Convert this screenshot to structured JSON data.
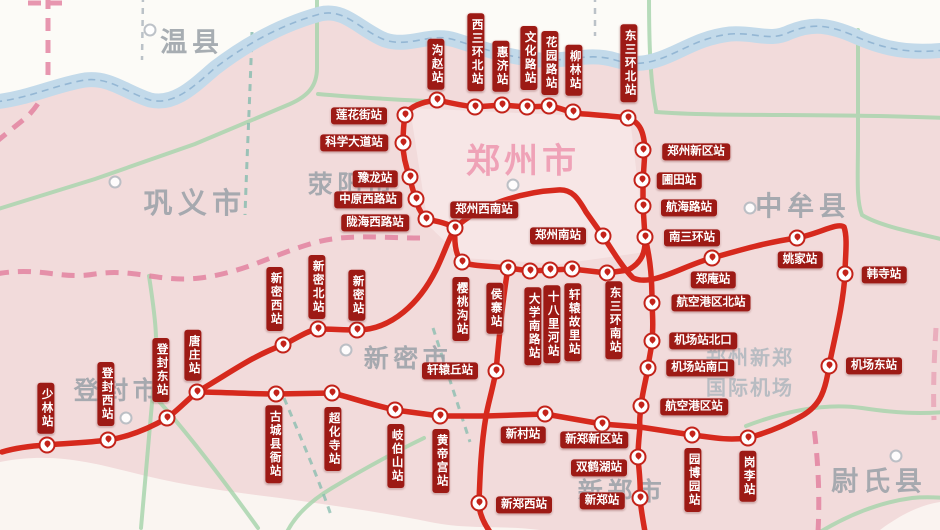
{
  "map": {
    "colors": {
      "background": "#f2dbdb",
      "line_red": "#d6291d",
      "label_bg": "#9d1a15",
      "label_text": "#ffffff",
      "river_blue": "#c3daea",
      "road_green": "#a5d4ab",
      "boundary_pink": "#e27d9d",
      "region_text": "#9ba2a9",
      "city_accent_pink": "#ef9fb5"
    },
    "regions": [
      {
        "name": "温县",
        "x": 192,
        "y": 40,
        "size": 27,
        "accent": false
      },
      {
        "name": "巩义市",
        "x": 195,
        "y": 201,
        "size": 29,
        "accent": false
      },
      {
        "name": "荥阳市",
        "x": 352,
        "y": 183,
        "size": 25,
        "accent": false
      },
      {
        "name": "郑州市",
        "x": 523,
        "y": 158,
        "size": 34,
        "accent": true
      },
      {
        "name": "中牟县",
        "x": 803,
        "y": 204,
        "size": 27,
        "accent": false
      },
      {
        "name": "新密市",
        "x": 408,
        "y": 357,
        "size": 25,
        "accent": false
      },
      {
        "name": "登封市",
        "x": 118,
        "y": 389,
        "size": 25,
        "accent": false
      },
      {
        "name": "新郑市",
        "x": 622,
        "y": 490,
        "size": 25,
        "accent": false
      },
      {
        "name": "尉氏县",
        "x": 879,
        "y": 479,
        "size": 27,
        "accent": false
      }
    ],
    "airport": {
      "line1": "郑州新郑",
      "line2": "国际机场",
      "x": 750,
      "y1": 356,
      "y2": 386
    },
    "city_markers": [
      [
        150,
        30
      ],
      [
        115,
        182
      ],
      [
        513,
        185
      ],
      [
        750,
        208
      ],
      [
        346,
        350
      ],
      [
        126,
        418
      ],
      [
        896,
        456
      ]
    ],
    "stations": [
      {
        "name": "沟赵站",
        "dot": [
          437,
          100
        ],
        "label": [
          436,
          64
        ],
        "dir": "v"
      },
      {
        "name": "西三环北站",
        "dot": [
          475,
          107
        ],
        "label": [
          476,
          52
        ],
        "dir": "v"
      },
      {
        "name": "惠济站",
        "dot": [
          502,
          105
        ],
        "label": [
          501,
          66
        ],
        "dir": "v"
      },
      {
        "name": "文化路站",
        "dot": [
          527,
          107
        ],
        "label": [
          529,
          58
        ],
        "dir": "v"
      },
      {
        "name": "花园路站",
        "dot": [
          549,
          106
        ],
        "label": [
          550,
          63
        ],
        "dir": "v"
      },
      {
        "name": "柳林站",
        "dot": [
          573,
          112
        ],
        "label": [
          574,
          70
        ],
        "dir": "v"
      },
      {
        "name": "东三环北站",
        "dot": [
          628,
          118
        ],
        "label": [
          629,
          63
        ],
        "dir": "v"
      },
      {
        "name": "郑州新区站",
        "dot": [
          643,
          150
        ],
        "label": [
          696,
          152
        ],
        "dir": "h"
      },
      {
        "name": "圃田站",
        "dot": [
          642,
          180
        ],
        "label": [
          679,
          181
        ],
        "dir": "h"
      },
      {
        "name": "航海路站",
        "dot": [
          643,
          206
        ],
        "label": [
          689,
          208
        ],
        "dir": "h"
      },
      {
        "name": "南三环站",
        "dot": [
          645,
          237
        ],
        "label": [
          692,
          238
        ],
        "dir": "h"
      },
      {
        "name": "郑庵站",
        "dot": [
          712,
          258
        ],
        "label": [
          713,
          280
        ],
        "dir": "h"
      },
      {
        "name": "姚家站",
        "dot": [
          797,
          238
        ],
        "label": [
          800,
          260
        ],
        "dir": "h"
      },
      {
        "name": "韩寺站",
        "dot": [
          845,
          274
        ],
        "label": [
          884,
          275
        ],
        "dir": "h"
      },
      {
        "name": "机场东站",
        "dot": [
          829,
          366
        ],
        "label": [
          874,
          366
        ],
        "dir": "h"
      },
      {
        "name": "航空港区北站",
        "dot": [
          652,
          303
        ],
        "label": [
          711,
          303
        ],
        "dir": "h"
      },
      {
        "name": "机场站北口",
        "dot": [
          652,
          341
        ],
        "label": [
          703,
          341
        ],
        "dir": "h"
      },
      {
        "name": "机场站南口",
        "dot": [
          648,
          368
        ],
        "label": [
          700,
          368
        ],
        "dir": "h"
      },
      {
        "name": "航空港区站",
        "dot": [
          641,
          406
        ],
        "label": [
          694,
          407
        ],
        "dir": "h"
      },
      {
        "name": "双鹤湖站",
        "dot": [
          638,
          457
        ],
        "label": [
          599,
          468
        ],
        "dir": "h"
      },
      {
        "name": "新郑站",
        "dot": [
          640,
          498
        ],
        "label": [
          602,
          501
        ],
        "dir": "h"
      },
      {
        "name": "东三环南站",
        "dot": [
          607,
          273
        ],
        "label": [
          614,
          320
        ],
        "dir": "v"
      },
      {
        "name": "轩辕故里站",
        "dot": [
          572,
          269
        ],
        "label": [
          573,
          322
        ],
        "dir": "v"
      },
      {
        "name": "十八里河站",
        "dot": [
          550,
          270
        ],
        "label": [
          552,
          324
        ],
        "dir": "v"
      },
      {
        "name": "大学南路站",
        "dot": [
          530,
          271
        ],
        "label": [
          533,
          326
        ],
        "dir": "v"
      },
      {
        "name": "侯寨站",
        "dot": [
          508,
          268
        ],
        "label": [
          495,
          308
        ],
        "dir": "v"
      },
      {
        "name": "樱桃沟站",
        "dot": [
          462,
          262
        ],
        "label": [
          461,
          309
        ],
        "dir": "v"
      },
      {
        "name": "郑州西南站",
        "dot": [
          455,
          228
        ],
        "label": [
          484,
          210
        ],
        "dir": "h"
      },
      {
        "name": "陇海西路站",
        "dot": [
          426,
          219
        ],
        "label": [
          375,
          223
        ],
        "dir": "h"
      },
      {
        "name": "中原西路站",
        "dot": [
          416,
          199
        ],
        "label": [
          368,
          200
        ],
        "dir": "h"
      },
      {
        "name": "豫龙站",
        "dot": [
          410,
          177
        ],
        "label": [
          375,
          179
        ],
        "dir": "h"
      },
      {
        "name": "科学大道站",
        "dot": [
          403,
          143
        ],
        "label": [
          354,
          143
        ],
        "dir": "h"
      },
      {
        "name": "莲花街站",
        "dot": [
          405,
          115
        ],
        "label": [
          359,
          116
        ],
        "dir": "h"
      },
      {
        "name": "郑州南站",
        "dot": [
          603,
          236
        ],
        "label": [
          558,
          236
        ],
        "dir": "h"
      },
      {
        "name": "轩辕丘站",
        "dot": [
          496,
          371
        ],
        "label": [
          450,
          371
        ],
        "dir": "h"
      },
      {
        "name": "新郑西站",
        "dot": [
          479,
          503
        ],
        "label": [
          524,
          505
        ],
        "dir": "h"
      },
      {
        "name": "新村站",
        "dot": [
          545,
          414
        ],
        "label": [
          523,
          435
        ],
        "dir": "h"
      },
      {
        "name": "新郑新区站",
        "dot": [
          602,
          424
        ],
        "label": [
          594,
          440
        ],
        "dir": "h"
      },
      {
        "name": "园博园站",
        "dot": [
          692,
          435
        ],
        "label": [
          693,
          480
        ],
        "dir": "v"
      },
      {
        "name": "岗李站",
        "dot": [
          748,
          438
        ],
        "label": [
          748,
          476
        ],
        "dir": "v"
      },
      {
        "name": "少林站",
        "dot": [
          47,
          445
        ],
        "label": [
          46,
          408
        ],
        "dir": "v"
      },
      {
        "name": "登封西站",
        "dot": [
          108,
          440
        ],
        "label": [
          106,
          394
        ],
        "dir": "v"
      },
      {
        "name": "登封东站",
        "dot": [
          167,
          418
        ],
        "label": [
          161,
          370
        ],
        "dir": "v"
      },
      {
        "name": "唐庄站",
        "dot": [
          197,
          392
        ],
        "label": [
          193,
          355
        ],
        "dir": "v"
      },
      {
        "name": "新密西站",
        "dot": [
          283,
          345
        ],
        "label": [
          275,
          299
        ],
        "dir": "v"
      },
      {
        "name": "新密北站",
        "dot": [
          318,
          329
        ],
        "label": [
          317,
          287
        ],
        "dir": "v"
      },
      {
        "name": "新密站",
        "dot": [
          357,
          330
        ],
        "label": [
          357,
          295
        ],
        "dir": "v"
      },
      {
        "name": "古城县衙站",
        "dot": [
          276,
          394
        ],
        "label": [
          274,
          444
        ],
        "dir": "v"
      },
      {
        "name": "超化寺站",
        "dot": [
          332,
          393
        ],
        "label": [
          333,
          439
        ],
        "dir": "v"
      },
      {
        "name": "岐伯山站",
        "dot": [
          395,
          410
        ],
        "label": [
          396,
          456
        ],
        "dir": "v"
      },
      {
        "name": "黄帝宫站",
        "dot": [
          440,
          416
        ],
        "label": [
          441,
          461
        ],
        "dir": "v"
      }
    ]
  }
}
